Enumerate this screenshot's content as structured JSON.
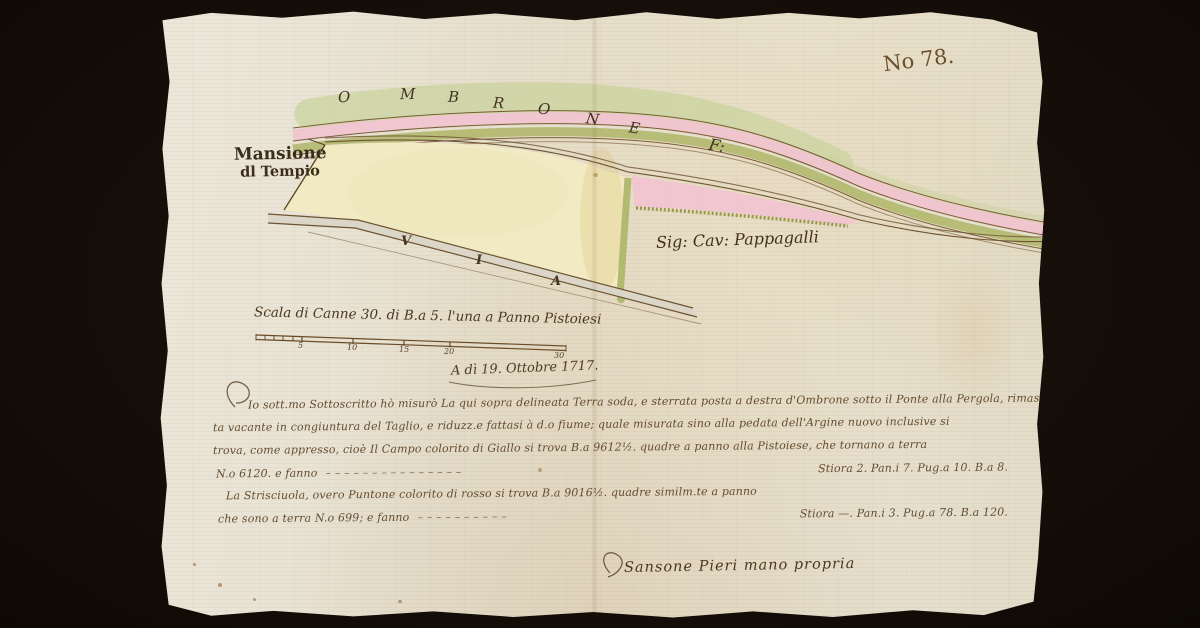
{
  "scan": {
    "background_color": "#160f09",
    "paper_color": "#eae4d6",
    "ink_color": "#503a20",
    "folio_number": "No 78.",
    "map": {
      "river_name_letters": [
        "O",
        "M",
        "B",
        "R",
        "O",
        "N",
        "E"
      ],
      "river_suffix": "F:",
      "mansione_label_line1": "Mansione",
      "mansione_label_line2": "dl Tempio",
      "owner_label": "Sig: Cav: Pappagalli",
      "road_letters": [
        "V",
        "I",
        "A"
      ],
      "colors": {
        "river_wash_green": "#c9d29c",
        "band_pink": "#f0c4d0",
        "band_olive": "#b1b86e",
        "field_yellow": "#f1eac3",
        "strip_pink": "#f2c3d0",
        "road_gray": "#dbd6c8",
        "hedge_green": "#b2ba72",
        "outline_brown": "#6d5331"
      }
    },
    "scale_bar": {
      "label": "Scala di Canne 30. di B.a 5. l'una a Panno Pistoiesi",
      "ticks": [
        "5",
        "10",
        "15",
        "20",
        "30"
      ]
    },
    "date_line": "A dì 19. Ottobre 1717.",
    "body": {
      "line1": "Io sott.mo Sottoscritto hò misurò La qui sopra delineata Terra soda, e sterrata posta a destra d'Ombrone sotto il Ponte alla Pergola, rimas=",
      "line2": "ta vacante in congiuntura del Taglio, e riduzz.e fattasi à d.o fiume; quale misurata sino alla pedata dell'Argine nuovo inclusive si",
      "line3": "trova, come appresso, cioè Il Campo colorito di Giallo si trova B.a 9612½. quadre a panno alla Pistoiese, che tornano a terra",
      "line4_left": "N.o 6120. e fanno",
      "line4_dashes": "– – – – – – – – – – – – – – –",
      "line4_right": "Stiora 2. Pan.i 7. Pug.a 10. B.a 8.",
      "line5": "La Strisciuola, overo Puntone colorito di rosso si trova B.a 9016½. quadre similm.te a panno",
      "line6_left": "che sono a terra N.o 699; e fanno",
      "line6_dashes": "– – – – – – – – – –",
      "line6_right": "Stiora —. Pan.i 3. Pug.a 78. B.a 120."
    },
    "signature": "Sansone Pieri mano propria"
  }
}
